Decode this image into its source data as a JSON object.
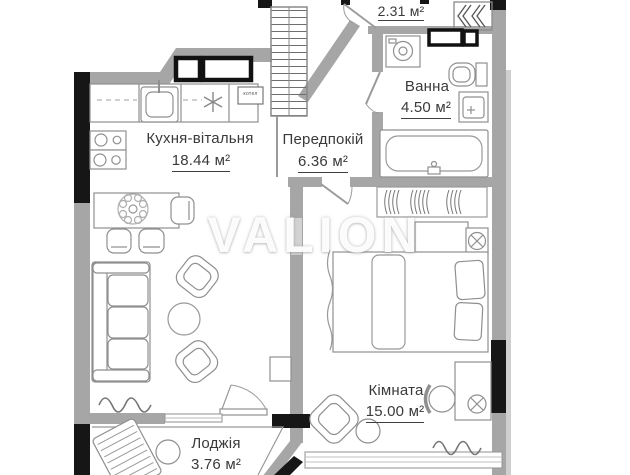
{
  "watermark": "VALION",
  "rooms": {
    "closet": {
      "area": "2.31 м²"
    },
    "kitchen": {
      "name": "Кухня-вітальня",
      "area": "18.44 м²"
    },
    "hallway": {
      "name": "Передпокій",
      "area": "6.36 м²"
    },
    "bathroom": {
      "name": "Ванна",
      "area": "4.50 м²"
    },
    "bedroom": {
      "name": "Кімната",
      "area": "15.00 м²"
    },
    "loggia": {
      "name": "Лоджія",
      "area": "3.76 м²"
    }
  },
  "labels": {
    "boiler": "котел"
  },
  "colors": {
    "background": "#ffffff",
    "wall": "#a6a6a6",
    "wall_dark": "#161616",
    "wall_light": "#cfcfcf",
    "furniture_line": "#8f8f8f",
    "text": "#3a3a3a",
    "watermark": "#ffffff"
  }
}
